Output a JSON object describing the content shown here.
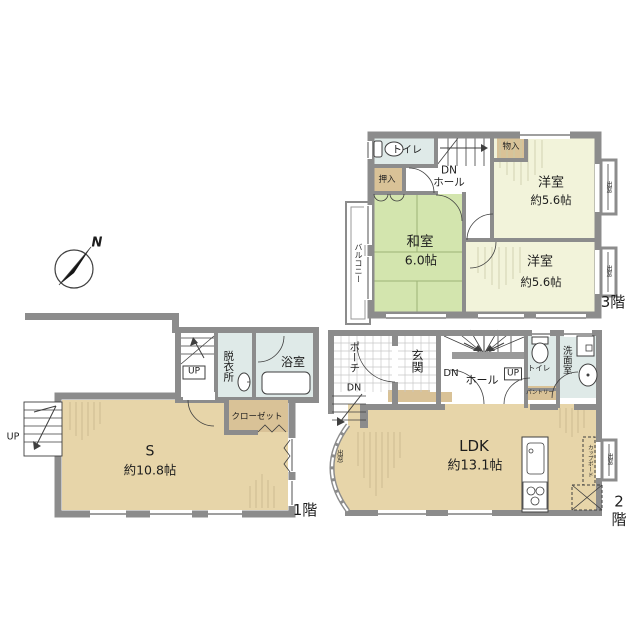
{
  "palette": {
    "wall": "#8c8c8c",
    "line": "#3f3f3f",
    "cream": "#f2f3da",
    "green": "#d3e5ae",
    "tan": "#e7d5a9",
    "tan2": "#d9c297",
    "blue": "#dfeae8",
    "tile": "#c8c8c8",
    "hatch-tan": "#c5b489",
    "hatch-cream": "#c9cbaa"
  },
  "compass": {
    "north": "N"
  },
  "floors": {
    "f3": {
      "floor_label": "3階",
      "toilet": "トイレ",
      "storage": "物入",
      "closet": "押入",
      "stair_hall": "DN\nホール",
      "western1_name": "洋室",
      "western1_size": "約5.6帖",
      "japanese_name": "和室",
      "japanese_size": "6.0帖",
      "western2_name": "洋室",
      "western2_size": "約5.6帖",
      "balcony": "バルコニー",
      "bay_window": "出窓"
    },
    "f2": {
      "floor_label": "2階",
      "porch": "ポーチ",
      "porch_dn": "DN",
      "entrance": "玄関",
      "stairs_dn": "DN",
      "hall": "ホール",
      "stairs_up": "UP",
      "toilet": "トイレ",
      "washroom": "洗面室",
      "pantry": "パントリー",
      "ldk_name": "LDK",
      "ldk_size": "約13.1帖",
      "cupboard": "カップボード",
      "bay_window": "出窓"
    },
    "f1": {
      "floor_label": "1階",
      "stairs_up": "UP",
      "dressing": "脱衣所",
      "bathroom": "浴室",
      "closet": "クローゼット",
      "service_name": "S",
      "service_size": "約10.8帖",
      "ext_up": "UP"
    }
  }
}
